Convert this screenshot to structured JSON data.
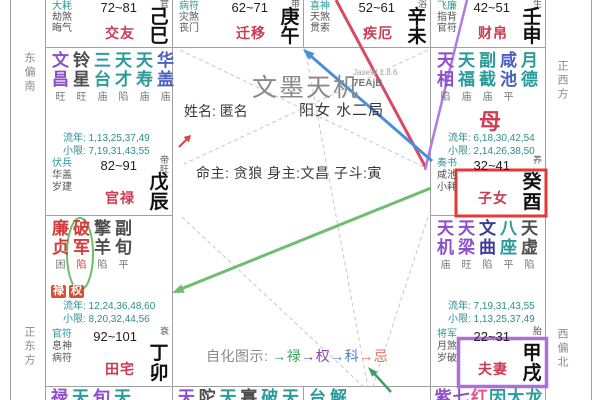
{
  "app": {
    "title": "文墨天机",
    "watermark1": "JaseW 1.8.6",
    "watermark2": "7EAjB"
  },
  "center": {
    "name_label": "姓名:",
    "name_value": "匿名",
    "gender_bureau": "阳女 水二局",
    "ming_line": "命主: 贪狼 身主:文昌 子斗:寅",
    "sihua_label": "自化图示:",
    "sihua_items": [
      {
        "text": "→禄",
        "color": "#3aa655"
      },
      {
        "text": "→权",
        "color": "#8e44ad"
      },
      {
        "text": "→科",
        "color": "#4a7fd4"
      },
      {
        "text": "→忌",
        "color": "#e8705f"
      }
    ]
  },
  "directions": {
    "left_top": "东偏南",
    "left_bottom": "正东方",
    "right_top": "正西方",
    "right_bottom": "西偏北"
  },
  "palaces": [
    {
      "id": "jiaoyou",
      "layout": "top",
      "col": 0,
      "gods": [
        "大耗",
        "劫煞",
        "晦气"
      ],
      "age": "72~81",
      "name": "交友",
      "sheng": "官",
      "branch": "己巳"
    },
    {
      "id": "qianyi",
      "layout": "top",
      "col": 1,
      "gods": [
        "病符",
        "灾煞",
        "丧门"
      ],
      "age": "62~71",
      "name": "迁移",
      "sheng": "带",
      "branch": "庚午"
    },
    {
      "id": "jie",
      "layout": "top",
      "col": 2,
      "gods": [
        "喜神",
        "天煞",
        "贯索"
      ],
      "age": "52~61",
      "name": "疾厄",
      "sheng": "浴",
      "branch": "辛未"
    },
    {
      "id": "caibo",
      "layout": "top",
      "col": 3,
      "gods": [
        "飞廉",
        "指背",
        "官符"
      ],
      "age": "42~51",
      "name": "财帛",
      "sheng": "生",
      "branch": "壬申"
    },
    {
      "id": "guanlu",
      "layout": "full",
      "col": 0,
      "row": 0,
      "stars": [
        [
          "文昌",
          "purple",
          "旺"
        ],
        [
          "铃星",
          "dark",
          "旺"
        ],
        [
          "三台",
          "teal",
          "庙"
        ],
        [
          "天才",
          "teal",
          "陷"
        ],
        [
          "天寿",
          "teal",
          "庙"
        ],
        [
          "华盖",
          "blue",
          "庙"
        ]
      ],
      "liunian": "流年: 1,13,25,37,49",
      "xiaoxian": "小限: 7,19,31,43,55",
      "gods": [
        "伏兵",
        "华盖",
        "岁建"
      ],
      "age": "82~91",
      "name": "官禄",
      "sheng": "帝旺",
      "branch": "戊辰"
    },
    {
      "id": "zinv",
      "layout": "full",
      "col": 3,
      "row": 0,
      "stars": [
        [
          "天相",
          "purple",
          "陷"
        ],
        [
          "天福",
          "teal",
          "庙"
        ],
        [
          "副截",
          "teal",
          "庙"
        ],
        [
          "咸池",
          "blue",
          "平"
        ],
        [
          "月德",
          "teal",
          ""
        ]
      ],
      "mu": "母",
      "liunian": "流年: 6,18,30,42,54",
      "xiaoxian": "小限: 2,14,26,38,50",
      "gods": [
        "奏书",
        "咸池",
        "小耗"
      ],
      "age": "32~41",
      "name": "子女",
      "sheng": "养",
      "branch": "癸酉",
      "highlight": "red"
    },
    {
      "id": "tianzhai",
      "layout": "full",
      "col": 0,
      "row": 1,
      "stars": [
        [
          "廉贞",
          "red",
          "困"
        ],
        [
          "破军",
          "red",
          "陷",
          "red"
        ],
        [
          "擎羊",
          "dark",
          "陷"
        ],
        [
          "副旬",
          "dark",
          "平"
        ]
      ],
      "badges": [
        "禄",
        "权"
      ],
      "liunian": "流年: 12,24,36,48,60",
      "xiaoxian": "小限: 8,20,32,44,56",
      "gods": [
        "官符",
        "息神",
        "病符"
      ],
      "age": "92~101",
      "name": "田宅",
      "sheng": "衰",
      "branch": "丁卯"
    },
    {
      "id": "fuqi",
      "layout": "full",
      "col": 3,
      "row": 1,
      "stars": [
        [
          "天机",
          "purple",
          "庙"
        ],
        [
          "天梁",
          "purple",
          "旺"
        ],
        [
          "文曲",
          "navy",
          "陷"
        ],
        [
          "八座",
          "teal",
          "平"
        ],
        [
          "天虚",
          "dark",
          "陷"
        ]
      ],
      "liunian": "流年: 7,19,31,43,55",
      "xiaoxian": "小限: 1,13,25,37,49",
      "gods": [
        "将军",
        "月煞",
        "岁破"
      ],
      "age": "22~31",
      "name": "夫妻",
      "sheng": "胎",
      "branch": "甲戌",
      "highlight": "purple"
    }
  ],
  "bottom_cells": [
    {
      "col": 0,
      "stars": [
        [
          "禄",
          "purple"
        ],
        [
          "天",
          "teal"
        ],
        [
          "旬",
          "purple"
        ],
        [
          "天",
          "teal"
        ]
      ]
    },
    {
      "col": 1,
      "stars": [
        [
          "天",
          "purple"
        ],
        [
          "陀",
          "dark"
        ],
        [
          "天",
          "teal"
        ],
        [
          "寡",
          "dark"
        ],
        [
          "破",
          "teal"
        ],
        [
          "天",
          "teal"
        ]
      ]
    },
    {
      "col": 2,
      "stars": [
        [
          "台",
          "teal"
        ],
        [
          "解",
          "teal"
        ]
      ]
    },
    {
      "col": 3,
      "stars": [
        [
          "紫",
          "purple"
        ],
        [
          "七",
          "purple"
        ],
        [
          "红",
          "pink"
        ],
        [
          "因",
          "teal"
        ],
        [
          "大",
          "teal"
        ],
        [
          "龙",
          "teal"
        ]
      ]
    }
  ],
  "palette": {
    "palace_red": "#cc3b50",
    "god_teal": "#2a9b9b",
    "grid": "#a0a0a0",
    "arrow_red": "#d84a63",
    "arrow_blue": "#4a90d8",
    "arrow_green": "#6fbe6f",
    "arrow_purple": "#b07ae0",
    "highlight_red": "#e43939",
    "highlight_purple": "#b06fd8"
  }
}
